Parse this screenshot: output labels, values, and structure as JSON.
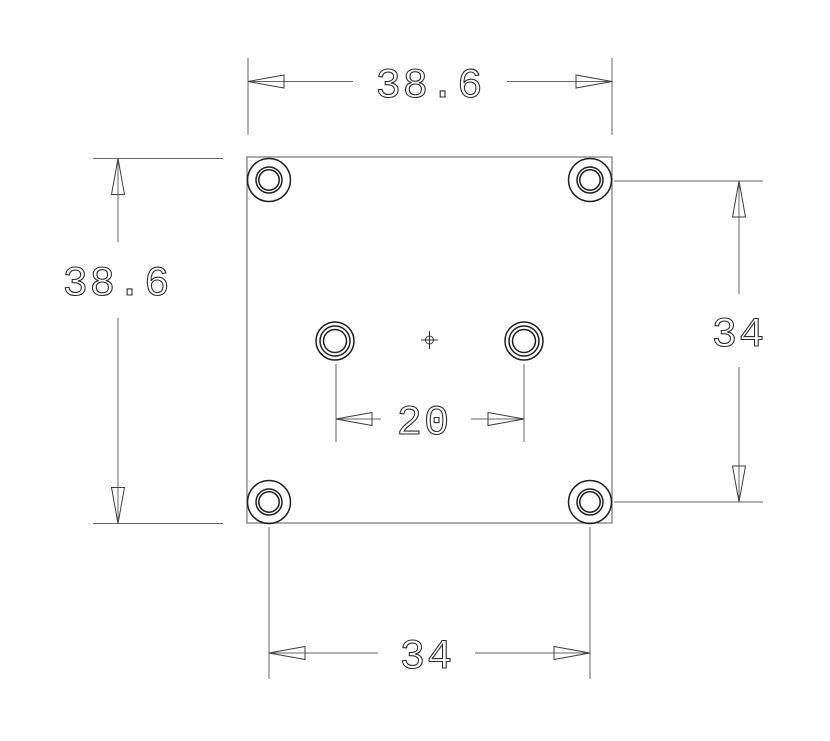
{
  "palette": {
    "background": "#ffffff",
    "line_color": "#666666",
    "feature_color": "#1f1f1f",
    "text_color": "#2e2e2e"
  },
  "drawing": {
    "kind": "mechanical part drawing, single orthographic view",
    "part": {
      "shape": "square plate",
      "corner_hole_count": 4,
      "center_hole_count": 2,
      "has_center_mark": true
    },
    "dimensions": {
      "overall_width": {
        "label": "38.6",
        "location": "top"
      },
      "overall_height": {
        "label": "38.6",
        "location": "left"
      },
      "corner_hole_vertical_spacing": {
        "label": "34",
        "location": "right"
      },
      "corner_hole_horizontal_spacing": {
        "label": "34",
        "location": "bottom"
      },
      "center_hole_spacing": {
        "label": "20",
        "location": "middle"
      }
    }
  }
}
